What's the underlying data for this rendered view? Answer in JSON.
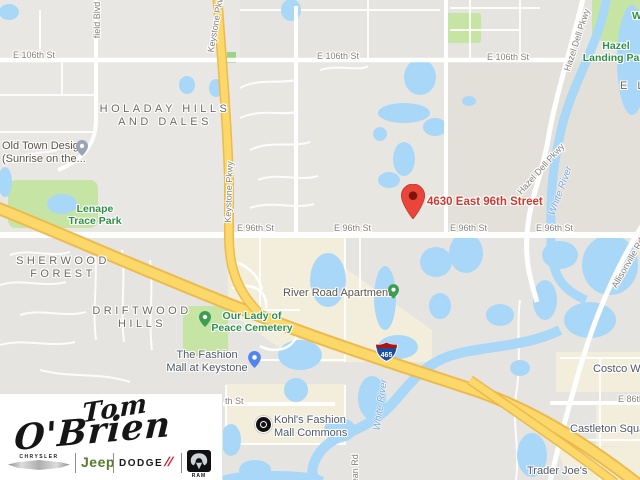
{
  "map": {
    "destination": {
      "label": "4630 East 96th Street"
    },
    "streets": {
      "e96": "E 96th St",
      "e106": "E 106th St",
      "e86": "E 86th St",
      "e86_fragment": "th St",
      "keystone": "Keystone Pkwy",
      "hazel_dell": "Hazel Dell Pkwy",
      "allisonville": "Allisonville Rd",
      "westfield_fragment": "field Blvd",
      "dean": "Dean Rd"
    },
    "neighborhoods": {
      "holaday": {
        "line1": "HOLADAY HILLS",
        "line2": "AND DALES"
      },
      "sherwood": {
        "line1": "SHERWOOD",
        "line2": "FOREST"
      },
      "driftwood": {
        "line1": "DRIFTWOOD",
        "line2": "HILLS"
      },
      "fragment_el": "E L"
    },
    "parks": {
      "lenape": {
        "line1": "Lenape",
        "line2": "Trace Park"
      },
      "hazel_landing": {
        "line1": "Hazel",
        "line2": "Landing Park"
      },
      "fragment_w": "W"
    },
    "pois": {
      "old_town": {
        "line1": "Old Town Design",
        "line2": "(Sunrise on the..."
      },
      "cemetery": {
        "line1": "Our Lady of",
        "line2": "Peace Cemetery"
      },
      "fashion_mall": {
        "line1": "The Fashion",
        "line2": "Mall at Keystone"
      },
      "river_road_apartments": "River Road Apartments",
      "kohls": {
        "line1": "Kohl's Fashion",
        "line2": "Mall Commons"
      },
      "costco": "Costco Wholesale",
      "castleton": "Castleton Square",
      "trader_joes": "Trader Joe's"
    },
    "water": {
      "white_river": "White River"
    },
    "highway": {
      "shield": "465"
    }
  },
  "logo": {
    "dealer_line1": "Tom",
    "dealer_line2": "O'Brien",
    "brands": {
      "chrysler": "CHRYSLER",
      "jeep": "Jeep",
      "dodge": "DODGE",
      "dodge_slashes": "//",
      "ram": "RAM"
    }
  },
  "colors": {
    "accent_red": "#ce392e",
    "water": "#a9d7f8",
    "park": "#c6e5a4",
    "highway": "#fbd869"
  }
}
